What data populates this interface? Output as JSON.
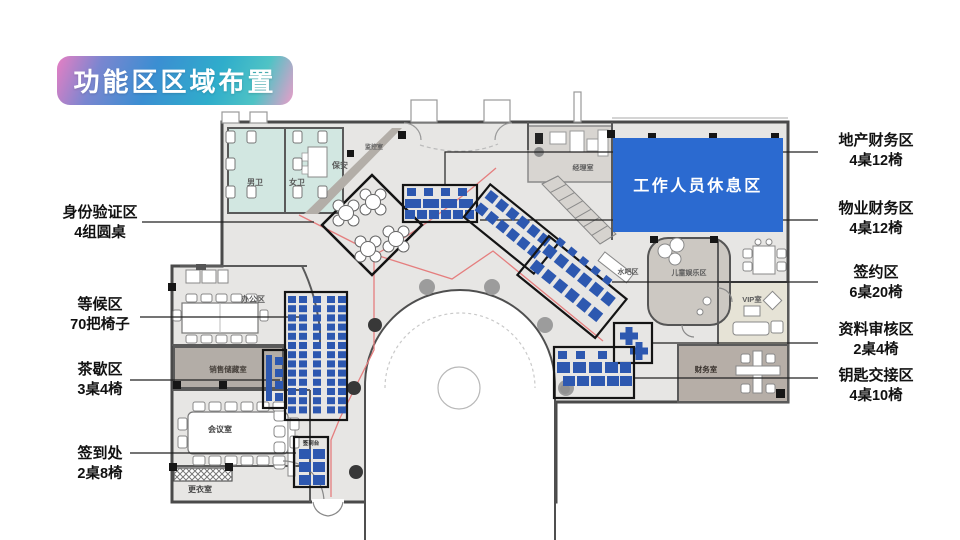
{
  "title": "功能区区域布置",
  "colors": {
    "desk_blue": "#2d58b0",
    "rest_area_blue": "#2b6ad0",
    "zone_outline": "#141414",
    "route_red": "#e57e7e",
    "restroom_teal": "#d2e7e1",
    "wall_gray": "#5a5a5a"
  },
  "rest_area": {
    "label": "工作人员休息区"
  },
  "rooms": {
    "male_wc": "男卫",
    "female_wc": "女卫",
    "security": "保安",
    "monitor_room": "监控室",
    "manager_room": "经理室",
    "office_area": "办公区",
    "sales_storage": "销售储藏室",
    "meeting_room": "会议室",
    "changing_room": "更衣室",
    "water_bar": "水吧区",
    "kids_zone": "儿童娱乐区",
    "vip_room": "VIP室",
    "finance_room": "财务室",
    "signin_desk": "签到台"
  },
  "callouts": {
    "left": [
      {
        "title": "身份验证区",
        "subtitle": "4组圆桌"
      },
      {
        "title": "等候区",
        "subtitle": "70把椅子"
      },
      {
        "title": "茶歇区",
        "subtitle": "3桌4椅"
      },
      {
        "title": "签到处",
        "subtitle": "2桌8椅"
      }
    ],
    "right": [
      {
        "title": "地产财务区",
        "subtitle": "4桌12椅"
      },
      {
        "title": "物业财务区",
        "subtitle": "4桌12椅"
      },
      {
        "title": "签约区",
        "subtitle": "6桌20椅"
      },
      {
        "title": "资料审核区",
        "subtitle": "2桌4椅"
      },
      {
        "title": "钥匙交接区",
        "subtitle": "4桌10椅"
      }
    ]
  }
}
